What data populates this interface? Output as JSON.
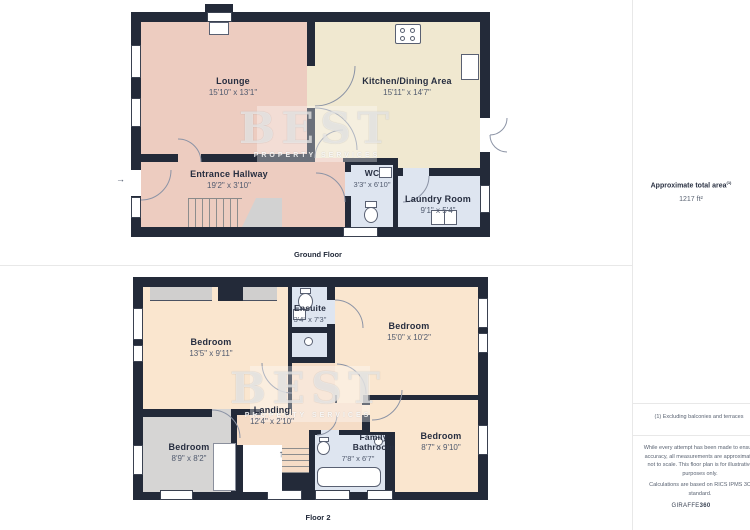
{
  "watermark": {
    "title": "BEST",
    "subtitle": "PROPERTY SERVICES"
  },
  "ground_floor": {
    "label": "Ground Floor",
    "rooms": [
      {
        "name": "Lounge",
        "dims": "15'10\" x 13'1\""
      },
      {
        "name": "Kitchen/Dining Area",
        "dims": "15'11\" x 14'7\""
      },
      {
        "name": "Entrance Hallway",
        "dims": "19'2\" x 3'10\""
      },
      {
        "name": "WC",
        "dims": "3'3\" x 6'10\""
      },
      {
        "name": "Laundry Room",
        "dims": "9'1\" x 5'4\""
      }
    ],
    "entry_arrow": "→"
  },
  "floor2": {
    "label": "Floor 2",
    "rooms": [
      {
        "name": "Bedroom",
        "dims": "13'5\" x 9'11\""
      },
      {
        "name": "Ensuite",
        "dims": "3'4\" x 7'3\""
      },
      {
        "name": "Bedroom",
        "dims": "15'0\" x 10'2\""
      },
      {
        "name": "Landing",
        "dims": "12'4\" x 2'10\""
      },
      {
        "name": "Bedroom",
        "dims": "8'9\" x 8'2\""
      },
      {
        "name": "Family Bathroom",
        "dims": "7'8\" x 6'7\""
      },
      {
        "name": "Bedroom",
        "dims": "8'7\" x 9'10\""
      }
    ],
    "stairs_arrow": "↑"
  },
  "sidebar": {
    "area_title": "Approximate total area",
    "area_superscript": "(1)",
    "area_value": "1217 ft²",
    "footnote": "(1) Excluding balconies and terraces",
    "disclaimer": "While every attempt has been made to ensure accuracy, all measurements are approximate, not to scale. This floor plan is for illustrative purposes only.",
    "standard": "Calculations are based on RICS IPMS 3C standard.",
    "brand": "GIRAFFE",
    "brand_bold": "360"
  },
  "colors": {
    "wall": "#232a39",
    "lounge_hall": "#edccc0",
    "kitchen": "#f0e8d0",
    "bath_blue": "#dee5f0",
    "bedroom_peach": "#fae6cf",
    "landing": "#f5dcc6",
    "gray_room": "#d6d5d4",
    "divider": "#e8e8e8"
  }
}
